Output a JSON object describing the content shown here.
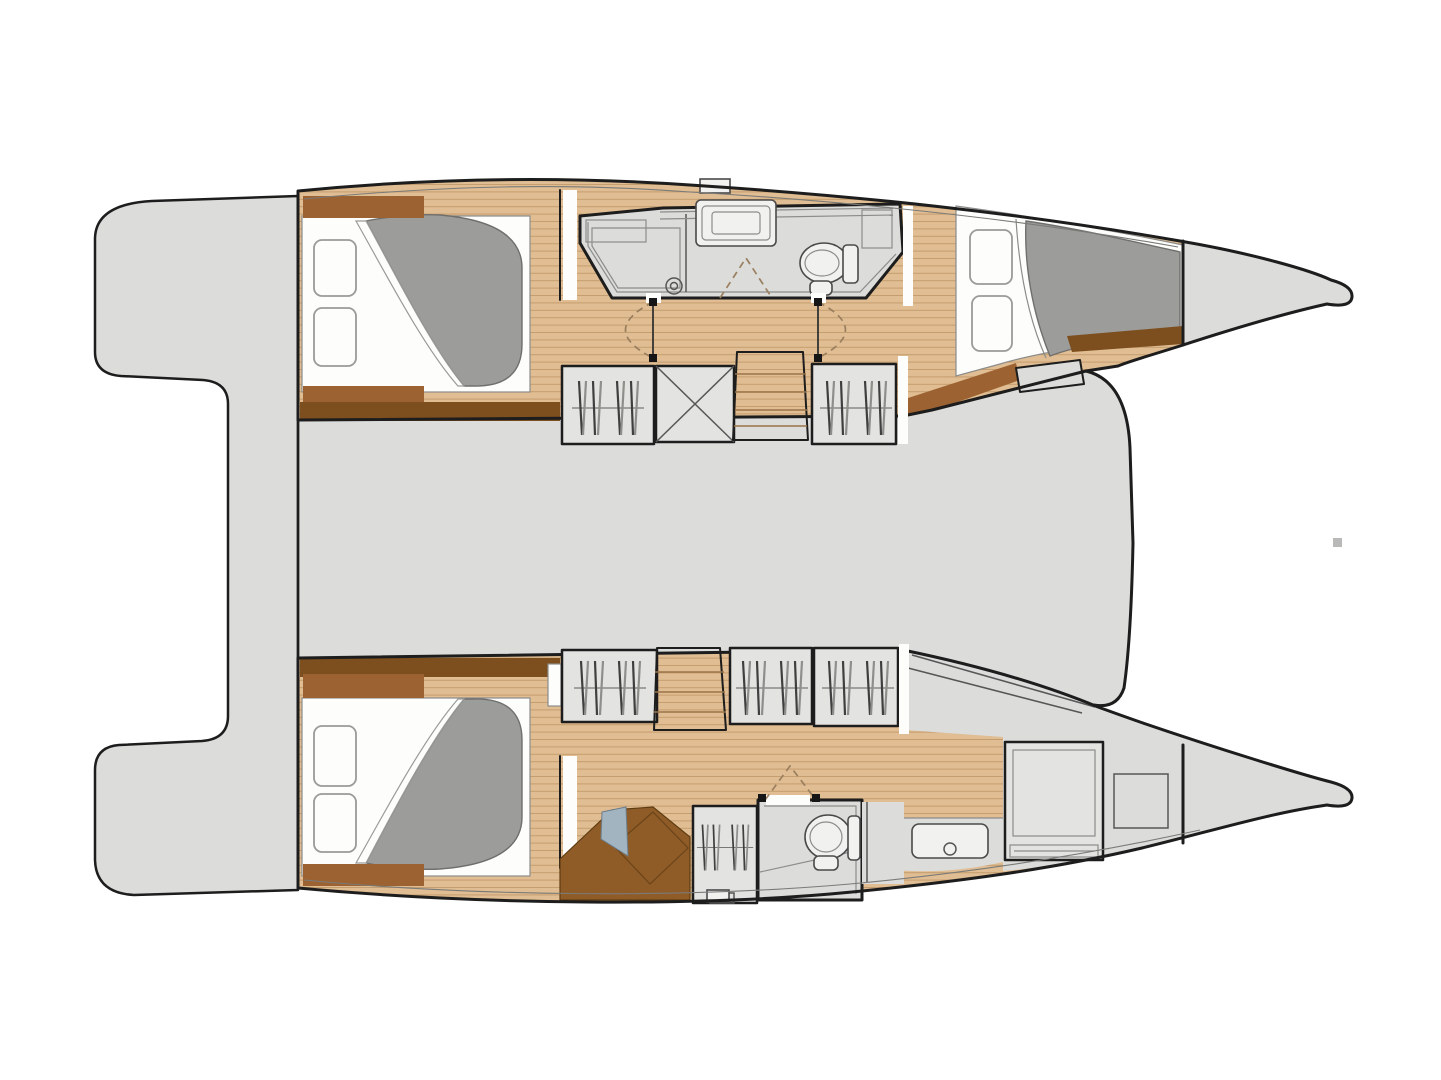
{
  "meta": {
    "title": "Catamaran interior layout plan — overhead deck view",
    "style": "architectural line drawing, no text labels",
    "orientation": "bow to the right, twin hulls top and bottom, bridge deck between"
  },
  "colors": {
    "bg": "#ffffff",
    "deck": "#dcdcda",
    "outline": "#1d1d1d",
    "wood": "#e0bd92",
    "wood_line": "#c49d6e",
    "wood_light": "#ecd5b2",
    "wood_light_line": "#d5b689",
    "brown": "#9c6232",
    "brown_dark": "#7d4e1e",
    "desk": "#8f5c28",
    "mattress": "#9c9c9a",
    "linen": "#fdfdfc",
    "fixture": "#f1f1ef",
    "locker": "#e3e3e1",
    "hanger": "#3f3f3f",
    "door_swing": "#9a7f5f",
    "seat": "#a3b4c1",
    "artifact": "#b9b9b7"
  },
  "vessel": {
    "type": "sailing catamaran",
    "sections": {
      "stern_platform": {
        "label": "aft transom platform with boarding recess"
      },
      "bridge_deck": {
        "label": "central bridge deck (shown unfurnished)"
      },
      "port_hull": {
        "label": "port hull (top)",
        "rooms": [
          {
            "name": "aft double cabin",
            "features": [
              "double berth",
              "two pillows",
              "grey mattress with turned sheet",
              "headboard shelves",
              "timber sole"
            ]
          },
          {
            "name": "shower room",
            "features": [
              "shower stall with drain",
              "vanity washbasin unit",
              "marine toilet with cistern",
              "two sliding doors with swing arcs",
              "deck hatch above"
            ]
          },
          {
            "name": "companionway passage",
            "features": [
              "hanging locker",
              "technical locker (X)",
              "companionway stairs",
              "hanging locker",
              "mast bulkhead gap"
            ]
          },
          {
            "name": "forward double cabin",
            "features": [
              "double berth",
              "two pillows",
              "grey mattress",
              "storage step",
              "timber sole"
            ]
          },
          {
            "name": "forepeak",
            "features": [
              "watertight bulkhead",
              "bow locker"
            ]
          }
        ]
      },
      "starboard_hull": {
        "label": "starboard hull (bottom)",
        "rooms": [
          {
            "name": "aft double cabin",
            "features": [
              "double berth",
              "two pillows",
              "grey mattress with turned sheet",
              "headboard shelves",
              "timber sole"
            ]
          },
          {
            "name": "companionway passage",
            "features": [
              "hanging locker",
              "companionway stairs",
              "hanging locker",
              "hanging locker",
              "mast bulkhead gap"
            ]
          },
          {
            "name": "dressing / desk area",
            "features": [
              "angled desk unit",
              "upholstered seat",
              "hanging locker with drawer"
            ]
          },
          {
            "name": "bathroom",
            "features": [
              "marine toilet with cistern",
              "door with swing arc"
            ]
          },
          {
            "name": "washstand area",
            "features": [
              "countertop with basin"
            ]
          },
          {
            "name": "forward berth compartment",
            "features": [
              "single berth with slatted rail",
              "storage hatch square"
            ]
          },
          {
            "name": "forepeak",
            "features": [
              "watertight bulkhead",
              "bow locker"
            ]
          }
        ]
      }
    }
  }
}
